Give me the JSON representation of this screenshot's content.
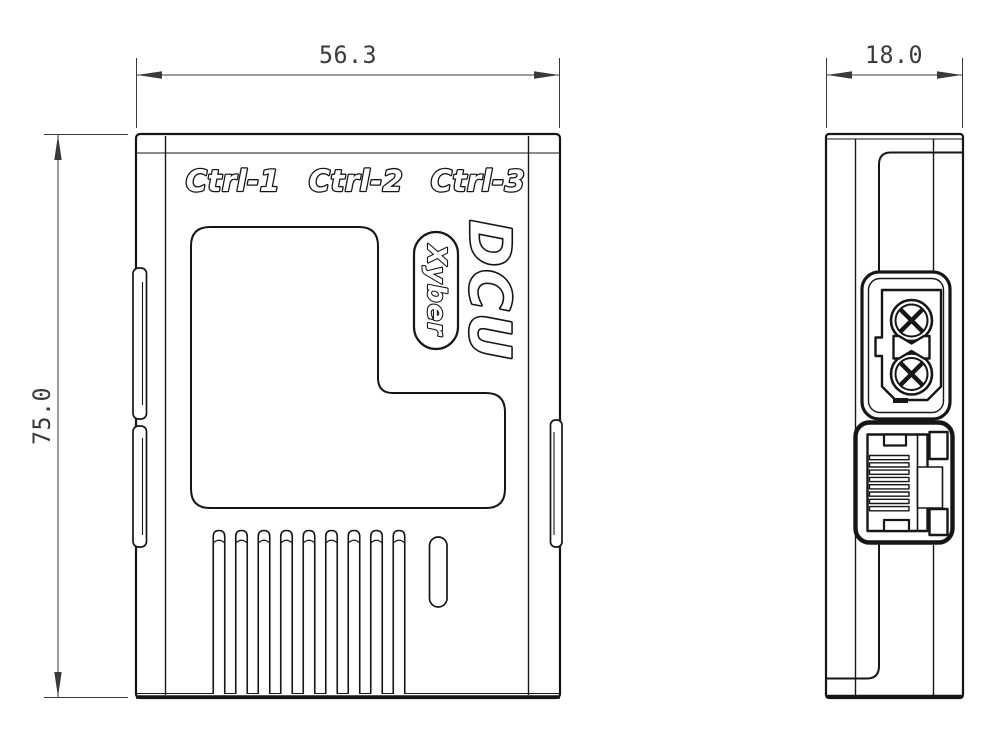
{
  "front_view": {
    "port_labels": [
      "Ctrl-1",
      "Ctrl-2",
      "Ctrl-3"
    ],
    "product_name": "DCU",
    "brand_name": "Xyber",
    "dim_width": "56.3",
    "dim_height": "75.0",
    "vent_slot_count": 9
  },
  "side_view": {
    "dim_depth": "18.0",
    "rj45_pin_count": 8
  },
  "colors": {
    "line": "#161616",
    "dimension": "#3a3a3a",
    "background": "#ffffff"
  }
}
